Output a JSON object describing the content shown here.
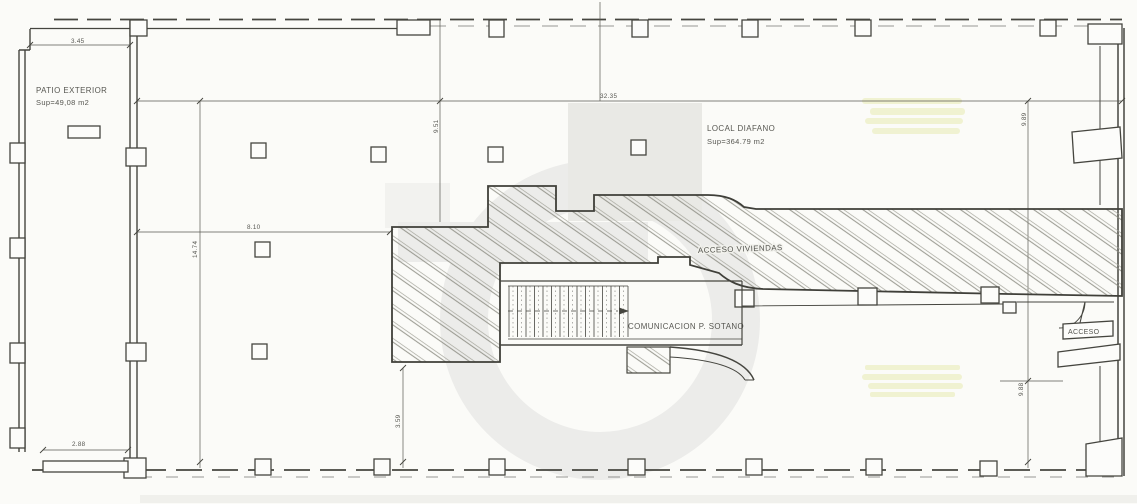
{
  "plan": {
    "rooms": {
      "patio": {
        "label": "PATIO EXTERIOR",
        "area": "Sup=49,08 m2"
      },
      "local": {
        "label": "LOCAL DIAFANO",
        "area": "Sup=364.79 m2"
      }
    },
    "annotations": {
      "acceso_viviendas": "ACCESO VIVIENDAS",
      "comunicacion_sotano": "COMUNICACION P. SOTANO",
      "acceso": "ACCESO"
    },
    "dimensions": {
      "patio_top_width": "3.45",
      "local_total_width": "32.35",
      "left_bay_depth": "9.51",
      "left_grid_width": "8.10",
      "patio_side_height": "14.74",
      "patio_bottom_width": "2.88",
      "lower_bay_depth": "3.59",
      "right_upper_depth": "9.89",
      "right_lower_depth": "9.88"
    },
    "colors": {
      "paper": "#fbfbf8",
      "ink": "#45453f",
      "shade": "#e9e9e5",
      "watermark": "#ececea",
      "highlight": "#eef0c8"
    }
  }
}
